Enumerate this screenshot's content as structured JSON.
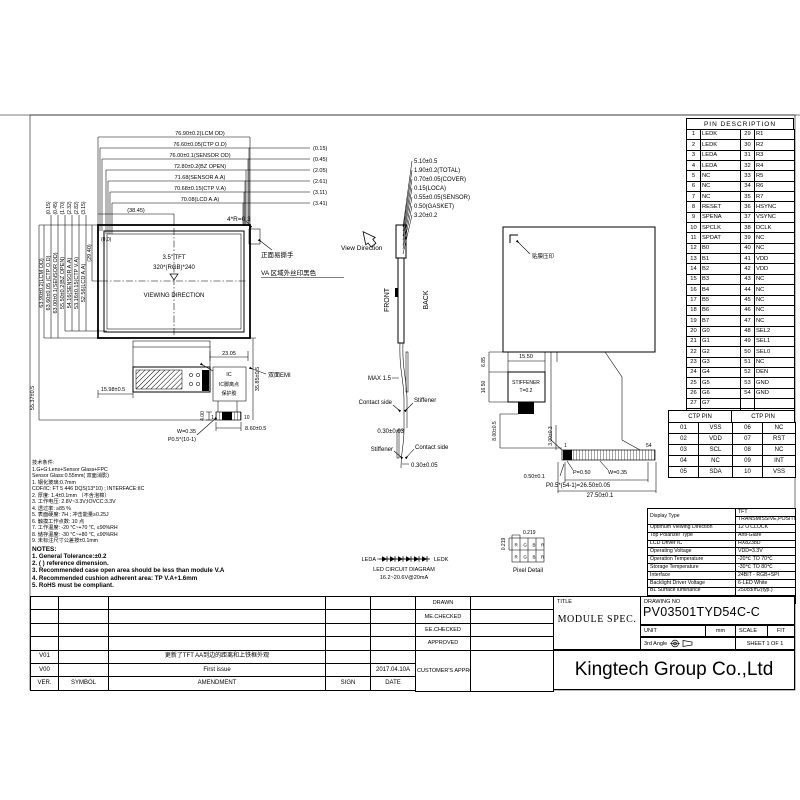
{
  "front_view": {
    "origin_label": "(0,0)",
    "size_label": "3.5\" TFT",
    "resolution": "320*(RGB)*240",
    "viewing_direction": "VIEWING DIRECTION",
    "corner_radius": "4*R=0.3",
    "tab_note": "正面易撕手",
    "va_note": "VA 区域外丝印黑色",
    "half_width": "(38.45)",
    "half_height": "(29.40)",
    "total_height": "55.37±0.5",
    "top_dims": [
      "76.90±0.2(LCM OD)",
      "76.60±0.05(CTP O.D)",
      "76.00±0.1(SENSOR OD)",
      "72.80±0.2(BZ OPEN)",
      "71.68(SENSOR A.A)",
      "70.68±0.15(CTP V.A)",
      "70.08(LCD A.A)"
    ],
    "top_offsets": [
      "(0.15)",
      "(0.45)",
      "(2.05)",
      "(2.61)",
      "(3.11)",
      "(3.41)"
    ],
    "left_dims": [
      "63.90±0.2(LCM OD)",
      "63.60±0.05 (CTP O.D)",
      "63.00±0.1(SENSOR OD)",
      "55.50±0.2(BZ OPEN)",
      "54.16(SENSOR A.A)",
      "53.16±0.15(CTP V.A)",
      "52.56(LCD A.A)"
    ],
    "left_offsets": [
      "(0.15)",
      "(0.45)",
      "(1.70)",
      "(2.32)",
      "(2.82)",
      "(3.15)"
    ],
    "fpc": {
      "fold_width": "23.05",
      "left_offset": "15.98±0.5",
      "tail_length": "35.85±0.5",
      "conn_length": "4.00",
      "conn_width": "8.60±0.5",
      "pin_first": "1",
      "pin_last": "10",
      "pin_width": "W=0.35",
      "pin_pitch": "P0.5*(10-1)",
      "ic_label": "IC",
      "ic_note1": "IC脚离点",
      "ic_note2": "保护胶",
      "emi_note": "双面EMI"
    }
  },
  "side_view": {
    "view_direction": "View Direction",
    "front": "FRONT",
    "back": "BACK",
    "stack": [
      "5.10±0.5",
      "1.90±0.2(TOTAL)",
      "0.70±0.05(COVER)",
      "0.15(LOCA)",
      "0.55±0.05(SENSOR)",
      "0.50(GASKET)",
      "3.20±0.2"
    ],
    "max": "MAX 1.5",
    "contact_top": "Contact side",
    "stiffener_top": "Stiffener",
    "dim_mid": "0.30±0.03",
    "stiffener_bot": "Stiffener",
    "contact_bot": "Contact side",
    "dim_end": "0.30±0.05"
  },
  "back_view": {
    "film_note": "贴膜压印",
    "stiffener_width": "15.50",
    "dim_685": "6.85",
    "dim_1650": "16.50",
    "stiffener1": "STIFFENER",
    "stiffener2": "T=0.2",
    "tail_length": "8.00±0.5",
    "dim_300": "3.00±0.3",
    "pin_first": "1",
    "pin_last": "54",
    "dim_050": "0.50±0.1",
    "pitch": "P=0.50",
    "pin_width": "W=0.35",
    "pitch_total": "P0.5*(54-1)=26.50±0.05",
    "conn_width": "27.50±0.1"
  },
  "led_circuit": {
    "anode": "LEDA",
    "cathode": "LEDK",
    "title": "LED CIRCUIT DIAGRAM",
    "rating": "16.2~20.6V@20mA"
  },
  "pixel_detail": {
    "dim_w": "0.219",
    "dim_h": "0.219",
    "rgb": "RGBR",
    "label": "Pixel Detail"
  },
  "pin_table": {
    "title": "PIN DESCRIPTION",
    "rows": [
      [
        "1",
        "LEDK",
        "29",
        "R1"
      ],
      [
        "2",
        "LEDK",
        "30",
        "R2"
      ],
      [
        "3",
        "LEDA",
        "31",
        "R3"
      ],
      [
        "4",
        "LEDA",
        "32",
        "R4"
      ],
      [
        "5",
        "NC",
        "33",
        "R5"
      ],
      [
        "6",
        "NC",
        "34",
        "R6"
      ],
      [
        "7",
        "NC",
        "35",
        "R7"
      ],
      [
        "8",
        "RESET",
        "36",
        "HSYNC"
      ],
      [
        "9",
        "SPENA",
        "37",
        "VSYNC"
      ],
      [
        "10",
        "SPCLK",
        "38",
        "DCLK"
      ],
      [
        "11",
        "SPDAT",
        "39",
        "NC"
      ],
      [
        "12",
        "B0",
        "40",
        "NC"
      ],
      [
        "13",
        "B1",
        "41",
        "VDD"
      ],
      [
        "14",
        "B2",
        "42",
        "VDD"
      ],
      [
        "15",
        "B3",
        "43",
        "NC"
      ],
      [
        "16",
        "B4",
        "44",
        "NC"
      ],
      [
        "17",
        "B5",
        "45",
        "NC"
      ],
      [
        "18",
        "B6",
        "46",
        "NC"
      ],
      [
        "19",
        "B7",
        "47",
        "NC"
      ],
      [
        "20",
        "G0",
        "48",
        "SEL2"
      ],
      [
        "21",
        "G1",
        "49",
        "SEL1"
      ],
      [
        "22",
        "G2",
        "50",
        "SEL0"
      ],
      [
        "23",
        "G3",
        "51",
        "NC"
      ],
      [
        "24",
        "G4",
        "52",
        "DEN"
      ],
      [
        "25",
        "G5",
        "53",
        "GND"
      ],
      [
        "26",
        "G6",
        "54",
        "GND"
      ],
      [
        "27",
        "G7",
        "",
        ""
      ],
      [
        "28",
        "R0",
        "",
        ""
      ]
    ]
  },
  "ctp_table": {
    "h1": "CTP PIN",
    "h2": "CTP PIN",
    "rows": [
      [
        "01",
        "VSS",
        "06",
        "NC"
      ],
      [
        "02",
        "VDD",
        "07",
        "RST"
      ],
      [
        "03",
        "SCL",
        "08",
        "NC"
      ],
      [
        "04",
        "NC",
        "09",
        "INT"
      ],
      [
        "05",
        "SDA",
        "10",
        "VSS"
      ]
    ]
  },
  "spec_table": {
    "rows": [
      [
        "Display Type",
        "TFT"
      ],
      [
        null,
        "TRANSMISSIVE,POSITIVE"
      ],
      [
        "Optimum Viewing Direction",
        "12 O'CLOCK"
      ],
      [
        "Top Polarizer Type",
        "Anti-Glare"
      ],
      [
        "LCD Driver IC",
        "HX8238D"
      ],
      [
        "Operating Voltage",
        "VDD=3.3V"
      ],
      [
        "Operation Temperature",
        "-20℃ TO 70℃"
      ],
      [
        "Storage Temperature",
        "-30℃ TO 80℃"
      ],
      [
        "Interface",
        "24BIT - RGB+SPI"
      ],
      [
        "Backlight Driver Voltage",
        "6-LED White"
      ],
      [
        "BL Surface luminance",
        "250cd/m2(typ.)"
      ],
      [
        "White X/Y",
        "TBD."
      ]
    ]
  },
  "title_block": {
    "title_label": "TITLE",
    "title": "MODULE SPEC.",
    "drawing_no_label": "DRAWING NO",
    "drawing_no": "PV03501TYD54C-C",
    "unit_label": "UNIT",
    "unit": "mm",
    "scale_label": "SCALE",
    "scale": "FIT",
    "angle": "3rd Angle",
    "sheet": "SHEET 1 OF 1",
    "company": "Kingtech Group Co.,Ltd"
  },
  "approval": {
    "rows": [
      [
        "DRAWN",
        ""
      ],
      [
        "ME.CHECKED",
        ""
      ],
      [
        "EE.CHECKED",
        ""
      ],
      [
        "APPROVED",
        ""
      ],
      [
        "CUSTOMER'S APPROVAL",
        ""
      ]
    ]
  },
  "revision": {
    "rows": [
      [
        "",
        "",
        "",
        "",
        ""
      ],
      [
        "",
        "",
        "",
        "",
        ""
      ],
      [
        "",
        "",
        "",
        "",
        ""
      ],
      [
        "",
        "",
        "",
        "",
        ""
      ],
      [
        "V01",
        "",
        "更新了TFT AA到边的距离和上铁框外观",
        "",
        ""
      ],
      [
        "V00",
        "",
        "First issue",
        "",
        "2017.04.10A"
      ],
      [
        "VER.",
        "SYMBOL",
        "AMENDMENT",
        "SIGN",
        "DATE"
      ]
    ]
  },
  "notes": {
    "title": "NOTES:",
    "lines": [
      "1. General Tolerance:±0.2",
      "2. ( ) reference dimension.",
      "3. Recommended case open area should be less than module V.A",
      "4. Recommended cushion adherent area: TP V.A+1.6mm",
      "5. RoHS must be compliant."
    ]
  },
  "tech_notes": {
    "lines": [
      "技术条件:",
      "1.G+G:Lens+Sensor Glass+FPC",
      "Sensor Glass:0.55mm(      双面消影)",
      "1. 钢化玻璃:0.7mm",
      "COF/IC:  FT 5   446 DQS(13*10)   ; INTERFACE:IIC",
      "2. 厚度: 1.4±0.1mm  （不含泡棉）",
      "3. 工作电压: 2.8V~3.3V;IOVCC:3.3V",
      "4. 透过率: ≥85 %",
      "5. 表面硬度: 7H ; 冲击能量≥0.25J",
      "6. 触摸工作点数: 10 点",
      "7. 工作温度: -20 ℃~+70 ℃, ≤90%RH",
      "8. 储存温度: -30 ℃~+80 ℃, ≤90%RH",
      "9. 未标注尺寸公差按±0.1mm"
    ]
  }
}
